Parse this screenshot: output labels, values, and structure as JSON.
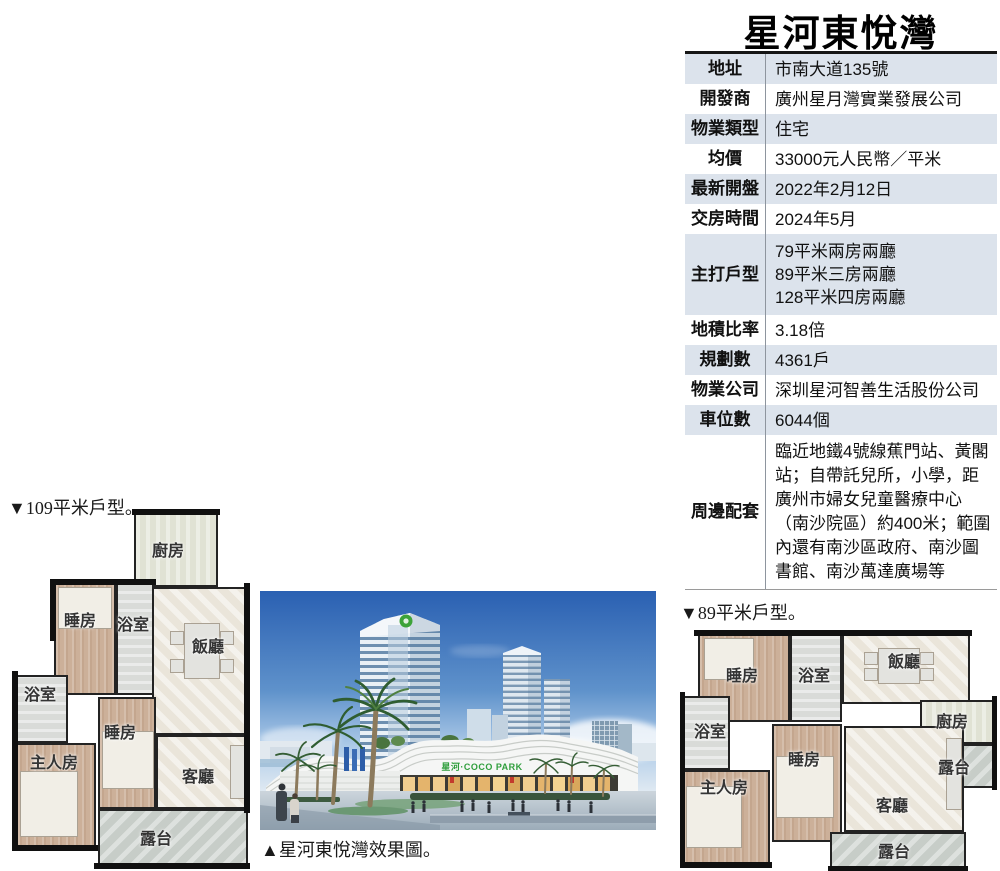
{
  "header": {
    "title": "星河東悅灣"
  },
  "info_table": {
    "shade_color": "#dce3ec",
    "rows": [
      {
        "label": "地址",
        "value": "市南大道135號"
      },
      {
        "label": "開發商",
        "value": "廣州星月灣實業發展公司"
      },
      {
        "label": "物業類型",
        "value": "住宅"
      },
      {
        "label": "均價",
        "value": "33000元人民幣／平米"
      },
      {
        "label": "最新開盤",
        "value": "2022年2月12日"
      },
      {
        "label": "交房時間",
        "value": "2024年5月"
      },
      {
        "label": "主打戶型",
        "value": "79平米兩房兩廳\n89平米三房兩廳\n128平米四房兩廳"
      },
      {
        "label": "地積比率",
        "value": "3.18倍"
      },
      {
        "label": "規劃數",
        "value": "4361戶"
      },
      {
        "label": "物業公司",
        "value": "深圳星河智善生活股份公司"
      },
      {
        "label": "車位數",
        "value": "6044個"
      },
      {
        "label": "周邊配套",
        "value": "臨近地鐵4號線蕉門站、黃閣站；自帶託兒所，小學，距廣州市婦女兒童醫療中心（南沙院區）約400米；範圍內還有南沙區政府、南沙圖書館、南沙萬達廣場等"
      }
    ]
  },
  "floorplan_109": {
    "caption": "▼109平米戶型。",
    "rooms": {
      "kitchen": "廚房",
      "dining": "飯廳",
      "bedroom1": "睡房",
      "bath1": "浴室",
      "bath2": "浴室",
      "master": "主人房",
      "bedroom2": "睡房",
      "living": "客廳",
      "terrace": "露台"
    }
  },
  "floorplan_89": {
    "caption": "▼89平米戶型。",
    "rooms": {
      "bedroom1": "睡房",
      "bath1": "浴室",
      "dining": "飯廳",
      "kitchen": "廚房",
      "terrace_right": "露台",
      "bath2": "浴室",
      "master": "主人房",
      "bedroom2": "睡房",
      "living": "客廳",
      "terrace_bottom": "露台"
    }
  },
  "render": {
    "caption": "▲星河東悅灣效果圖。",
    "mall_sign": "星河·COCO PARK",
    "logo_color": "#3da339"
  }
}
